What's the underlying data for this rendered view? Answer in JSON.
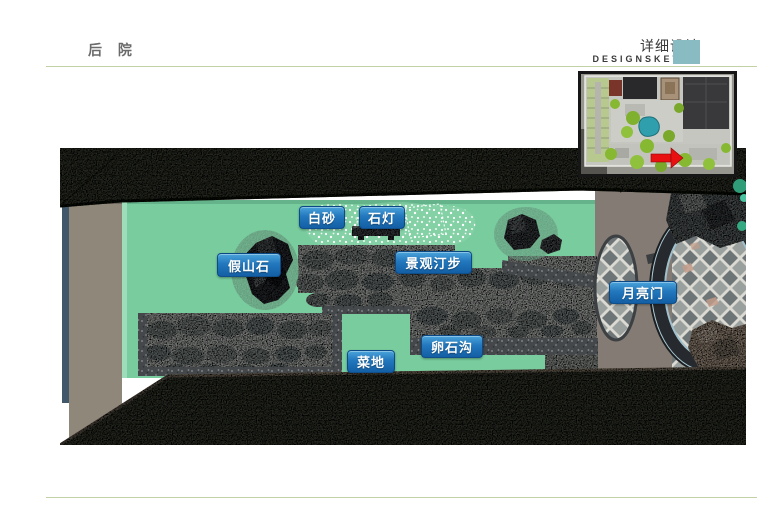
{
  "header": {
    "section_title": "后 院",
    "detail_title": "详细设计",
    "detail_subtitle": "DESIGNSKETCH",
    "accent_square_color": "#88bcc2",
    "rule_color": "#c2d2a4"
  },
  "plan": {
    "labels": [
      {
        "id": "white-sand",
        "text": "白砂"
      },
      {
        "id": "stone-lantern",
        "text": "石灯"
      },
      {
        "id": "rockery-stone",
        "text": "假山石"
      },
      {
        "id": "stepping-stones",
        "text": "景观汀步"
      },
      {
        "id": "moon-gate",
        "text": "月亮门"
      },
      {
        "id": "pebble-ditch",
        "text": "卵石沟"
      },
      {
        "id": "vegetable-plot",
        "text": "菜地"
      }
    ],
    "label_bg_color": "#1f6fb4",
    "courtyard_green": "#78cc9e",
    "roof_color": "#474a40",
    "moon_gate_ring_color": "#26292d"
  },
  "inset": {
    "arrow_icon": "red-arrow-icon",
    "arrow_color": "#e81010"
  }
}
